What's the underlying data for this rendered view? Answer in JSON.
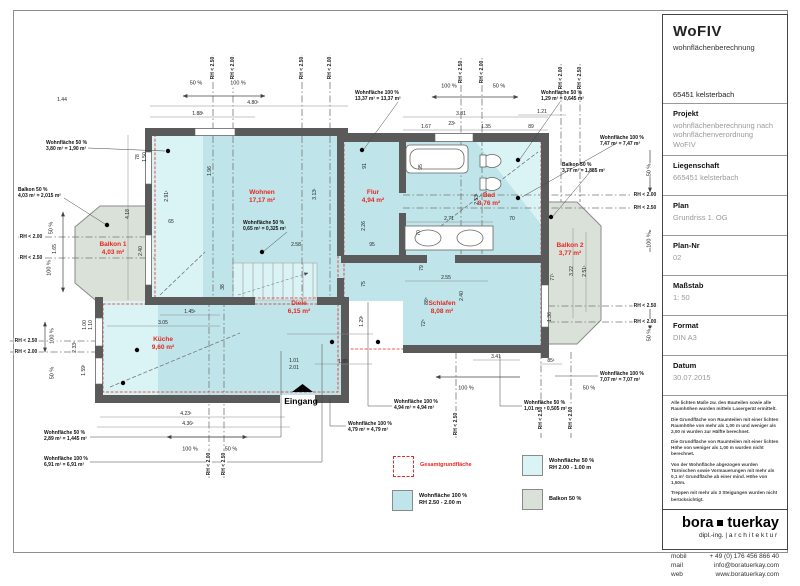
{
  "title_block": {
    "title": "WoFIV",
    "subtitle": "wohnflächenberechnung",
    "address": "65451 kelsterbach",
    "fields": [
      {
        "label": "Projekt",
        "value": "wohnflächenberechnung nach wohnflächenverordnung WoFIV"
      },
      {
        "label": "Liegenschaft",
        "value": "665451 kelsterbach"
      },
      {
        "label": "Plan",
        "value": "Grundriss 1. OG"
      },
      {
        "label": "Plan-Nr",
        "value": "02"
      },
      {
        "label": "Maßstab",
        "value": "1: 50"
      },
      {
        "label": "Format",
        "value": "DIN A3"
      },
      {
        "label": "Datum",
        "value": "30.07.2015"
      }
    ],
    "notes": [
      "Alle lichten Maße zw. den Bauteilen sowie alle Raumhöhen wurden mittels Lasergerät ermittelt.",
      "Die Grundfläche von Raumteilen mit einer lichten Raumhöhe von mehr als 1,00 m und weniger als 2,00 m wurden zur Hälfte berechnet.",
      "Die Grundfläche von Raumteilen mit einer lichten Höhe von weniger als 1,00 m wurden nicht berechnet.",
      "Von der Wohnfläche abgezogen wurden Türnischen sowie Vormauerungen mit mehr als 0,1 m² Grundfläche ab einer mind. Höhe von 1,50m.",
      "Treppen mit mehr als 3 Steigungen wurden nicht berücksichtigt."
    ],
    "logo": {
      "name_left": "bora",
      "name_right": "tuerkay",
      "tagline_left": "dipl.-ing. |",
      "tagline_right": "architektur"
    },
    "contact": [
      {
        "label": "mobil",
        "value": "+ 49 (0) 176 456 866 40"
      },
      {
        "label": "mail",
        "value": "info@boratuerkay.com"
      },
      {
        "label": "web",
        "value": "www.boratuerkay.com"
      }
    ]
  },
  "legend": {
    "items": [
      {
        "label1": "Gesamtgrundfläche",
        "label2": "",
        "color_key": "none",
        "style": "red-dashed"
      },
      {
        "label1": "Wohnfläche 100 %",
        "label2": "RH 2.50 - 2.00 m",
        "color_key": "c100",
        "style": "swatch"
      },
      {
        "label1": "Wohnfläche 50 %",
        "label2": "RH 2.00 - 1.00 m",
        "color_key": "c50",
        "style": "swatch"
      },
      {
        "label1": "Balkon 50 %",
        "label2": "",
        "color_key": "balkon",
        "style": "swatch"
      }
    ]
  },
  "plan": {
    "entrance_label": "Eingang",
    "colors": {
      "c100": "#bfe5ea",
      "c50": "#daf3f4",
      "balkon": "#dae1d9",
      "wall": "#5a5a5a",
      "red": "#e8271f"
    },
    "rooms": [
      {
        "name": "Wohnen",
        "area": "17,17 m²",
        "x": 262,
        "y": 197
      },
      {
        "name": "Flur",
        "area": "4,94 m²",
        "x": 373,
        "y": 197
      },
      {
        "name": "Bad",
        "area": "8,76 m²",
        "x": 489,
        "y": 200
      },
      {
        "name": "Balkon 1",
        "area": "4,03 m²",
        "x": 113,
        "y": 249
      },
      {
        "name": "Balkon 2",
        "area": "3,77 m²",
        "x": 570,
        "y": 250
      },
      {
        "name": "Küche",
        "area": "9,60 m²",
        "x": 163,
        "y": 344
      },
      {
        "name": "Diele",
        "area": "6,15 m²",
        "x": 299,
        "y": 308
      },
      {
        "name": "Schlafen",
        "area": "8,08 m²",
        "x": 442,
        "y": 308
      }
    ],
    "annotations": [
      {
        "line1": "Wohnfläche 50 %",
        "line2": "3,80 m² = 1,90 m²",
        "x": 46,
        "y": 140
      },
      {
        "line1": "Balkon 50 %",
        "line2": "4,03 m² = 2,015 m²",
        "x": 18,
        "y": 187
      },
      {
        "line1": "Wohnfläche 100 %",
        "line2": "13,37 m² = 13,37 m²",
        "x": 355,
        "y": 90
      },
      {
        "line1": "Wohnfläche 50 %",
        "line2": "1,29 m² = 0,645 m²",
        "x": 541,
        "y": 90
      },
      {
        "line1": "Wohnfläche 100 %",
        "line2": "7,47 m² = 7,47 m²",
        "x": 600,
        "y": 135
      },
      {
        "line1": "Balkon 50 %",
        "line2": "3,77 m² = 1,885 m²",
        "x": 562,
        "y": 162
      },
      {
        "line1": "Wohnfläche 50 %",
        "line2": "0,65 m² = 0,325 m²",
        "x": 243,
        "y": 220
      },
      {
        "line1": "Wohnfläche 50 %",
        "line2": "2,89 m² = 1,445 m²",
        "x": 44,
        "y": 430
      },
      {
        "line1": "Wohnfläche 100 %",
        "line2": "6,91 m² = 6,91 m²",
        "x": 44,
        "y": 456
      },
      {
        "line1": "Wohnfläche 100 %",
        "line2": "4,94 m² = 4,94 m²",
        "x": 394,
        "y": 399
      },
      {
        "line1": "Wohnfläche 100 %",
        "line2": "4,79 m² = 4,79 m²",
        "x": 348,
        "y": 421
      },
      {
        "line1": "Wohnfläche 50 %",
        "line2": "1,01 m² = 0,505 m²",
        "x": 524,
        "y": 400
      },
      {
        "line1": "Wohnfläche 100 %",
        "line2": "7,07 m² = 7,07 m²",
        "x": 600,
        "y": 371
      }
    ],
    "dimensions": [
      {
        "t": "1.44",
        "x": 62,
        "y": 100
      },
      {
        "t": "1.88¹",
        "x": 198,
        "y": 114
      },
      {
        "t": "4.80¹",
        "x": 253,
        "y": 103
      },
      {
        "t": "3.81",
        "x": 461,
        "y": 114
      },
      {
        "t": "1.67",
        "x": 426,
        "y": 127
      },
      {
        "t": "23¹",
        "x": 452,
        "y": 124
      },
      {
        "t": "1.35",
        "x": 486,
        "y": 127
      },
      {
        "t": "1.21",
        "x": 542,
        "y": 112
      },
      {
        "t": "89",
        "x": 531,
        "y": 127
      },
      {
        "t": "4.18",
        "x": 128,
        "y": 214,
        "v": 1
      },
      {
        "t": "2.40",
        "x": 141,
        "y": 251,
        "v": 1
      },
      {
        "t": "1.65",
        "x": 55,
        "y": 249,
        "v": 1
      },
      {
        "t": "2.91¹",
        "x": 167,
        "y": 196,
        "v": 1
      },
      {
        "t": "1.96",
        "x": 210,
        "y": 171,
        "v": 1
      },
      {
        "t": "78",
        "x": 138,
        "y": 157,
        "v": 1
      },
      {
        "t": "1.50",
        "x": 145,
        "y": 157,
        "v": 1
      },
      {
        "t": "65",
        "x": 171,
        "y": 222
      },
      {
        "t": "3.13¹",
        "x": 315,
        "y": 194,
        "v": 1
      },
      {
        "t": "91",
        "x": 365,
        "y": 166,
        "v": 1
      },
      {
        "t": "2.26",
        "x": 364,
        "y": 226,
        "v": 1
      },
      {
        "t": "95",
        "x": 372,
        "y": 245
      },
      {
        "t": "75",
        "x": 364,
        "y": 284,
        "v": 1
      },
      {
        "t": "1.29¹",
        "x": 362,
        "y": 321,
        "v": 1
      },
      {
        "t": "2.58",
        "x": 296,
        "y": 245
      },
      {
        "t": "2.53¹",
        "x": 477,
        "y": 199,
        "v": 1
      },
      {
        "t": "95",
        "x": 421,
        "y": 167,
        "v": 1
      },
      {
        "t": "2.71",
        "x": 449,
        "y": 219
      },
      {
        "t": "70",
        "x": 512,
        "y": 219
      },
      {
        "t": "70",
        "x": 419,
        "y": 233,
        "v": 1
      },
      {
        "t": "79",
        "x": 422,
        "y": 268,
        "v": 1
      },
      {
        "t": "2.55",
        "x": 446,
        "y": 278
      },
      {
        "t": "2.40",
        "x": 462,
        "y": 296,
        "v": 1
      },
      {
        "t": "88⁵",
        "x": 427,
        "y": 301,
        "v": 1
      },
      {
        "t": "72⁵",
        "x": 424,
        "y": 323,
        "v": 1
      },
      {
        "t": "3.22",
        "x": 572,
        "y": 271,
        "v": 1
      },
      {
        "t": "2.51¹",
        "x": 585,
        "y": 271,
        "v": 1
      },
      {
        "t": "77¹",
        "x": 553,
        "y": 277,
        "v": 1
      },
      {
        "t": "1.36",
        "x": 550,
        "y": 317,
        "v": 1
      },
      {
        "t": "3.05",
        "x": 163,
        "y": 323
      },
      {
        "t": "1.45¹",
        "x": 190,
        "y": 312
      },
      {
        "t": "1.00",
        "x": 85,
        "y": 325,
        "v": 1
      },
      {
        "t": "1.10",
        "x": 91,
        "y": 325,
        "v": 1
      },
      {
        "t": "2.33¹",
        "x": 75,
        "y": 347,
        "v": 1
      },
      {
        "t": "1.59¹",
        "x": 84,
        "y": 370,
        "v": 1
      },
      {
        "t": "4.23¹",
        "x": 186,
        "y": 414
      },
      {
        "t": "4.36¹",
        "x": 188,
        "y": 424
      },
      {
        "t": "1.01",
        "x": 294,
        "y": 361
      },
      {
        "t": "2.01",
        "x": 294,
        "y": 368
      },
      {
        "t": "1.85",
        "x": 343,
        "y": 362
      },
      {
        "t": "3.41",
        "x": 496,
        "y": 357
      },
      {
        "t": "85¹",
        "x": 551,
        "y": 361
      },
      {
        "t": "38",
        "x": 223,
        "y": 287,
        "v": 1
      }
    ],
    "rh_markers": [
      {
        "t": "RH < 2.00",
        "x": 31,
        "y": 237
      },
      {
        "t": "RH < 2.50",
        "x": 31,
        "y": 258
      },
      {
        "t": "RH < 2.50",
        "x": 26,
        "y": 341
      },
      {
        "t": "RH < 2.00",
        "x": 26,
        "y": 352
      },
      {
        "t": "RH < 2.00",
        "x": 645,
        "y": 195
      },
      {
        "t": "RH < 2.50",
        "x": 645,
        "y": 208
      },
      {
        "t": "RH < 2.50",
        "x": 645,
        "y": 306
      },
      {
        "t": "RH < 2.00",
        "x": 645,
        "y": 322
      },
      {
        "t": "RH < 2.50",
        "x": 213,
        "y": 68,
        "v": 1
      },
      {
        "t": "RH < 2.00",
        "x": 233,
        "y": 68,
        "v": 1
      },
      {
        "t": "RH < 2.50",
        "x": 302,
        "y": 68,
        "v": 1
      },
      {
        "t": "RH < 2.00",
        "x": 330,
        "y": 68,
        "v": 1
      },
      {
        "t": "RH < 2.50",
        "x": 461,
        "y": 72,
        "v": 1
      },
      {
        "t": "RH < 2.00",
        "x": 482,
        "y": 72,
        "v": 1
      },
      {
        "t": "RH < 2.00",
        "x": 561,
        "y": 78,
        "v": 1
      },
      {
        "t": "RH < 2.50",
        "x": 580,
        "y": 78,
        "v": 1
      },
      {
        "t": "RH < 2.50",
        "x": 456,
        "y": 424,
        "v": 1
      },
      {
        "t": "RH < 2.50",
        "x": 541,
        "y": 418,
        "v": 1
      },
      {
        "t": "RH < 2.00",
        "x": 571,
        "y": 418,
        "v": 1
      },
      {
        "t": "RH < 2.00",
        "x": 209,
        "y": 464,
        "v": 1
      },
      {
        "t": "RH < 2.50",
        "x": 224,
        "y": 464,
        "v": 1
      }
    ],
    "percent_labels": [
      {
        "t": "50 %",
        "x": 196,
        "y": 84
      },
      {
        "t": "100 %",
        "x": 238,
        "y": 84
      },
      {
        "t": "100 %",
        "x": 449,
        "y": 87
      },
      {
        "t": "50 %",
        "x": 499,
        "y": 87
      },
      {
        "t": "50 %",
        "x": 52,
        "y": 228,
        "v": 1
      },
      {
        "t": "100 %",
        "x": 50,
        "y": 268,
        "v": 1
      },
      {
        "t": "50 %",
        "x": 650,
        "y": 170,
        "v": 1
      },
      {
        "t": "100 %",
        "x": 650,
        "y": 240,
        "v": 1
      },
      {
        "t": "50 %",
        "x": 650,
        "y": 335,
        "v": 1
      },
      {
        "t": "100 %",
        "x": 53,
        "y": 336,
        "v": 1
      },
      {
        "t": "50 %",
        "x": 53,
        "y": 373,
        "v": 1
      },
      {
        "t": "100 %",
        "x": 190,
        "y": 450
      },
      {
        "t": "50 %",
        "x": 231,
        "y": 450
      },
      {
        "t": "100 %",
        "x": 466,
        "y": 389
      },
      {
        "t": "50 %",
        "x": 589,
        "y": 389
      }
    ]
  }
}
